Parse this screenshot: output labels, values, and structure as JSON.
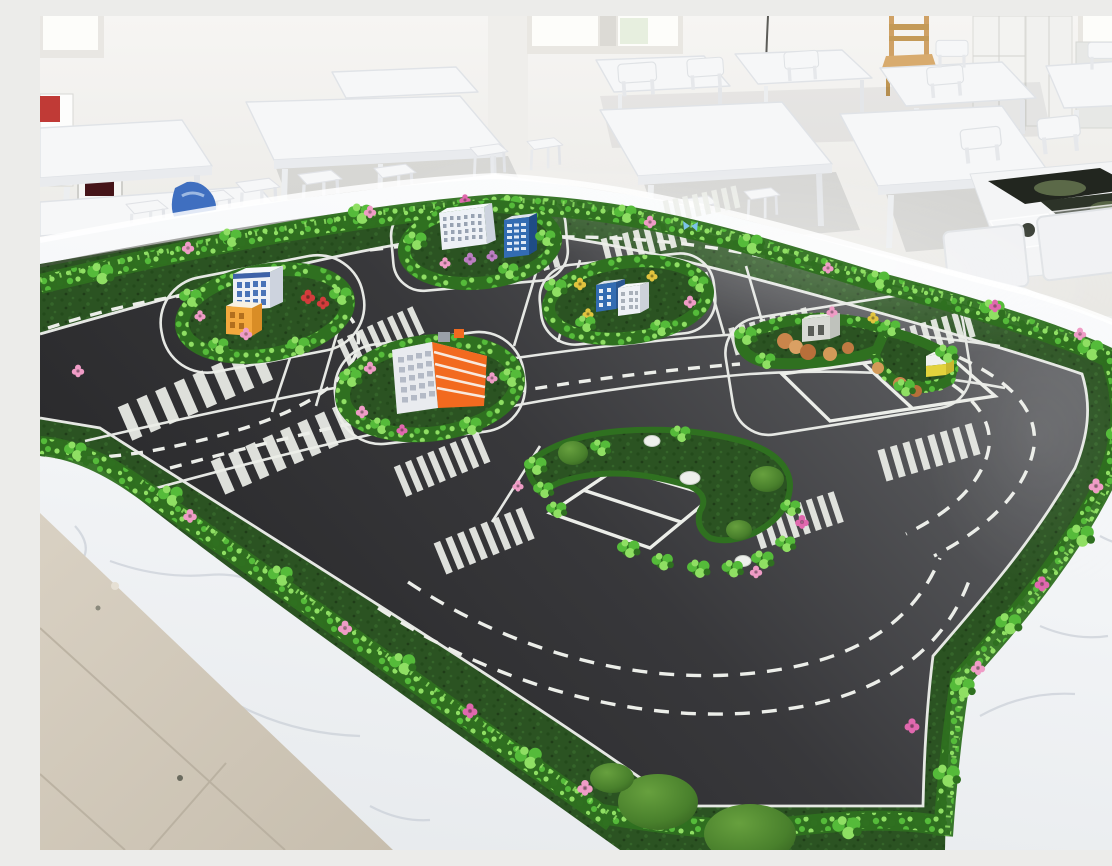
{
  "scene": {
    "type": "photograph",
    "description": "Bright training classroom with white desks and stools surrounding a large marble-edged table that holds a miniature smart-traffic road model with hedge borders, pink roses, toy buildings and white road markings",
    "no_visible_text": true
  },
  "palette": {
    "wall": "#f3f2ef",
    "wall_shade": "#e9e8e4",
    "window_bright": "#fdfdfa",
    "window_tint": "#e7efdf",
    "floor_tile": "#d3cabb",
    "grout": "#b6ad9d",
    "marble": "#f4f6f8",
    "marble_near": "#e9ecef",
    "marble_vein": "#c3c9d2",
    "rim_highlight": "#ffffff",
    "road_light": "#6a6b6e",
    "road_mid": "#3c3c3f",
    "road_dark": "#28282a",
    "marking": "#eceee9",
    "moss": "#2b5322",
    "moss_dark": "#1f3d18",
    "hedge_dark": "#2f7020",
    "hedge_mid": "#55bb3a",
    "hedge_light": "#8fdf63",
    "flower_pink": "#ef9cc6",
    "flower_deep_pink": "#e068ae",
    "flower_red": "#d23c3c",
    "flower_yellow": "#e2c43e",
    "flower_purple": "#bc7ec2",
    "furniture": "#f6f7f8",
    "furniture_edge": "#dfe2e6",
    "furniture_shadow": "#343a40",
    "wood": "#cfa165",
    "bldg_white": "#eef1f6",
    "bldg_white_side": "#cdd3de",
    "bldg_blue": "#336cb2",
    "bldg_blue_dark": "#1f4c86",
    "bldg_orange": "#f26a1f",
    "cube_orange": "#f3a83e",
    "bldg_gray": "#d8dad5",
    "kiosk_yellow": "#e3d23c",
    "tan_shrub": "#c9854b",
    "rock_white": "#eef0ec",
    "butterfly_blue": "#7cc4e8",
    "bag_blue": "#3f6fc0",
    "poster_red": "#c03a36",
    "print_dark": "#22261f",
    "print_green": "#6a7a52"
  },
  "classroom": {
    "windows": 3,
    "furniture": {
      "tables": 10,
      "stools": 9,
      "chair_backs": 9,
      "wooden_chairs": 1,
      "cabinets": 3
    },
    "objects": [
      "leaning-posters",
      "framed-picture",
      "blue-bag",
      "printed-road-maps",
      "plastic-part-bags",
      "wall-cable"
    ]
  },
  "model_table": {
    "surface": "white marble top and sides",
    "border": "dark moss strip with bright hedge bushes and rose flowers",
    "road_mat": {
      "surface": "dark asphalt-style mat",
      "markings": [
        "solid edge lines",
        "dashed lane lines",
        "zebra crosswalks",
        "parking bays"
      ],
      "crosswalk_count": 12
    },
    "islands": [
      {
        "id": "A",
        "position": "left",
        "buildings": [
          "white office with blue windows",
          "orange cube block"
        ],
        "flowers": [
          "red",
          "pink"
        ]
      },
      {
        "id": "B",
        "position": "top-center",
        "buildings": [
          "white slab with window grid",
          "blue tower"
        ],
        "flowers": [
          "purple",
          "pink"
        ]
      },
      {
        "id": "C",
        "position": "center",
        "buildings": [
          "orange-striped block with white facade"
        ],
        "flowers": [
          "pink"
        ]
      },
      {
        "id": "D",
        "position": "center-right",
        "buildings": [
          "small blue block",
          "small white block"
        ],
        "flowers": [
          "yellow",
          "pink"
        ]
      },
      {
        "id": "E",
        "position": "right",
        "buildings": [
          "gray utility block",
          "yellow kiosk"
        ],
        "shrubs": "tan",
        "extras": [
          "parking rectangle"
        ]
      },
      {
        "id": "F",
        "position": "bottom-center",
        "features": [
          "moss boulders",
          "white rocks",
          "parking bay with divider"
        ]
      }
    ],
    "decorations": [
      "moss boulders on bottom border",
      "blue butterfly accents",
      "purple rose on right border"
    ]
  }
}
